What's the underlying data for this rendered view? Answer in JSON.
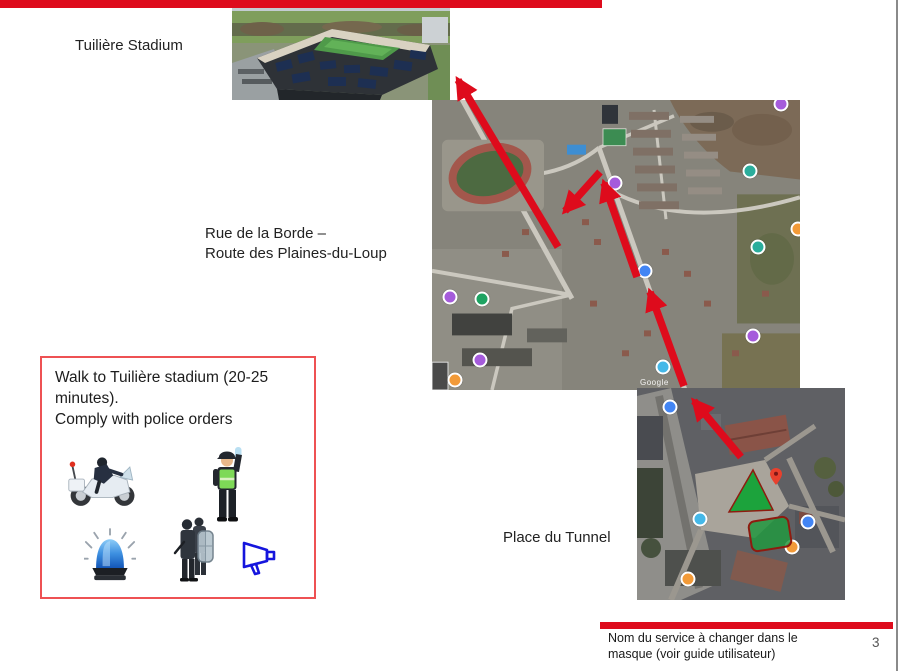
{
  "slide": {
    "labels": {
      "stadium": "Tuilière Stadium",
      "route_line1": "Rue de la Borde –",
      "route_line2": "Route des Plaines-du-Loup",
      "tunnel": "Place du Tunnel"
    },
    "info_box": {
      "text_line1": "Walk to Tuilière stadium (20-25 minutes).",
      "text_line2": "Comply with police orders",
      "icons": [
        "police-motorcycle",
        "traffic-police-officer",
        "police-beacon",
        "riot-police",
        "megaphone"
      ]
    },
    "footer": {
      "note": "Nom du service à changer dans le masque (voir guide utilisateur)",
      "page_number": "3"
    },
    "watermark": "Google",
    "colors": {
      "accent_red": "#DE0B1C",
      "box_border_red": "#EE5153",
      "arrow_red": "#DE0B1C",
      "triangle_green": "#1CA33C",
      "triangle_border": "#8E1B0F",
      "zone_green_fill": "rgba(34,152,64,0.85)",
      "zone_border_red": "#8E1B0F",
      "pin_red": "#E8402D",
      "page_number_gray": "#555555"
    },
    "route_arrows": [
      {
        "from": [
          558,
          247
        ],
        "to": [
          458,
          80
        ]
      },
      {
        "from": [
          600,
          172
        ],
        "to": [
          565,
          211
        ]
      },
      {
        "from": [
          637,
          277
        ],
        "to": [
          604,
          183
        ]
      },
      {
        "from": [
          684,
          386
        ],
        "to": [
          650,
          292
        ]
      },
      {
        "from": [
          741,
          457
        ],
        "to": [
          694,
          401
        ]
      }
    ],
    "mid_map_markers": [
      {
        "x": 349,
        "y": 4,
        "c": "#A55BDB"
      },
      {
        "x": 318,
        "y": 71,
        "c": "#2BAD9C"
      },
      {
        "x": 326,
        "y": 147,
        "c": "#2BAD9C"
      },
      {
        "x": 321,
        "y": 236,
        "c": "#A55BDB"
      },
      {
        "x": 213,
        "y": 171,
        "c": "#4285F4"
      },
      {
        "x": 183,
        "y": 83,
        "c": "#A55BDB"
      },
      {
        "x": 18,
        "y": 197,
        "c": "#A55BDB"
      },
      {
        "x": 50,
        "y": 199,
        "c": "#1EA362"
      },
      {
        "x": 48,
        "y": 260,
        "c": "#A55BDB"
      },
      {
        "x": 23,
        "y": 280,
        "c": "#F29A38"
      },
      {
        "x": 366,
        "y": 129,
        "c": "#F29A38"
      },
      {
        "x": 231,
        "y": 267,
        "c": "#45B8E8"
      }
    ],
    "bottom_map_markers": [
      {
        "x": 33,
        "y": 19,
        "c": "#4285F4"
      },
      {
        "x": 155,
        "y": 159,
        "c": "#F29A38"
      },
      {
        "x": 51,
        "y": 191,
        "c": "#F29A38"
      },
      {
        "x": 171,
        "y": 134,
        "c": "#4285F4"
      },
      {
        "x": 63,
        "y": 131,
        "c": "#45B8E8"
      }
    ]
  }
}
